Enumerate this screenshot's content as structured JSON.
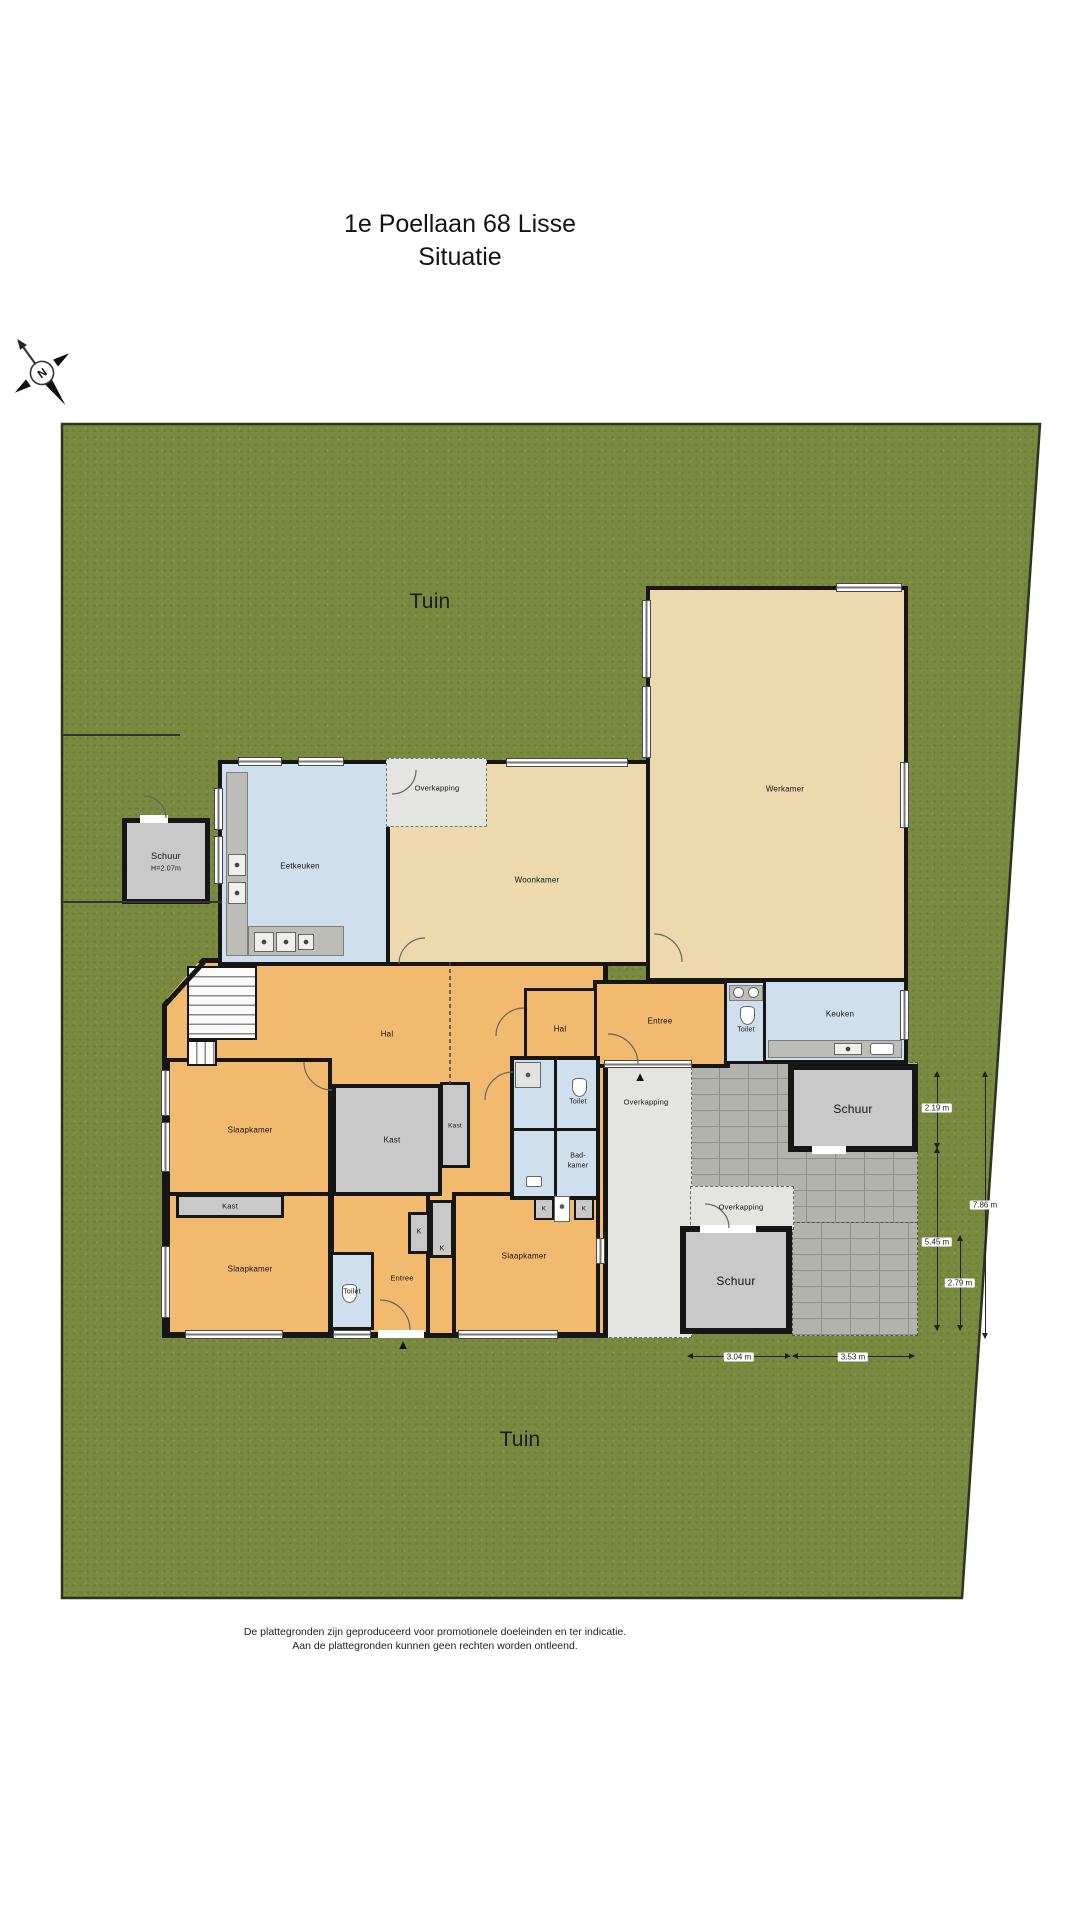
{
  "title": {
    "line1": "1e Poellaan 68 Lisse",
    "line2": "Situatie"
  },
  "compass": {
    "north_label": "N"
  },
  "garden": {
    "label_top": "Tuin",
    "label_bottom": "Tuin"
  },
  "rooms": {
    "schuur_left": {
      "label": "Schuur",
      "height": "H=2.07m"
    },
    "eetkeuken": {
      "label": "Eetkeuken"
    },
    "overkapping_top": {
      "label": "Overkapping"
    },
    "woonkamer": {
      "label": "Woonkamer"
    },
    "werkamer": {
      "label": "Werkamer"
    },
    "keuken": {
      "label": "Keuken"
    },
    "hal_main": {
      "label": "Hal"
    },
    "hal_small": {
      "label": "Hal"
    },
    "entree_upper": {
      "label": "Entree"
    },
    "toilet_upper": {
      "label": "Toilet"
    },
    "toilet_mid": {
      "label": "Toilet"
    },
    "badkamer": {
      "label_line1": "Bad-",
      "label_line2": "kamer"
    },
    "slaapkamer_1": {
      "label": "Slaapkamer"
    },
    "slaapkamer_2": {
      "label": "Slaapkamer"
    },
    "slaapkamer_3": {
      "label": "Slaapkamer"
    },
    "kast_1": {
      "label": "Kast"
    },
    "kast_2": {
      "label": "Kast"
    },
    "kast_3": {
      "label": "Kast"
    },
    "closet_k1": {
      "label": "K"
    },
    "closet_k2": {
      "label": "K"
    },
    "closet_k3": {
      "label": "K"
    },
    "closet_k4": {
      "label": "K"
    },
    "toilet_lower": {
      "label": "Toilet"
    },
    "entree_lower": {
      "label": "Entree"
    },
    "overkapping_mid": {
      "label": "Overkapping"
    },
    "overkapping_lower": {
      "label": "Overkapping"
    },
    "schuur_right": {
      "label": "Schuur"
    },
    "schuur_bottom": {
      "label": "Schuur"
    }
  },
  "measurements": {
    "right": [
      {
        "value": "2.19 m"
      },
      {
        "value": "7.86 m"
      },
      {
        "value": "5.45 m"
      },
      {
        "value": "2.79 m"
      }
    ],
    "bottom": [
      {
        "value": "3.04 m"
      },
      {
        "value": "3.53 m"
      }
    ]
  },
  "icons": {
    "entrance_marker": "▲"
  },
  "disclaimer": {
    "line1": "De plattegronden zijn geproduceerd voor promotionele doeleinden en ter indicatie.",
    "line2": "Aan de plattegronden kunnen geen rechten worden ontleend."
  },
  "colors": {
    "wall": "#161616",
    "garden_green": "#79893f",
    "garden_dark": "#6c7b36",
    "room_tan": "#eed9ae",
    "room_orange": "#f2ba6e",
    "room_blue": "#cfdfee",
    "room_gray": "#c9c9c9",
    "overkapping_gray": "#e4e4e1",
    "brick_gray": "#b3b3ad",
    "counter_gray": "#bdbdb7"
  }
}
